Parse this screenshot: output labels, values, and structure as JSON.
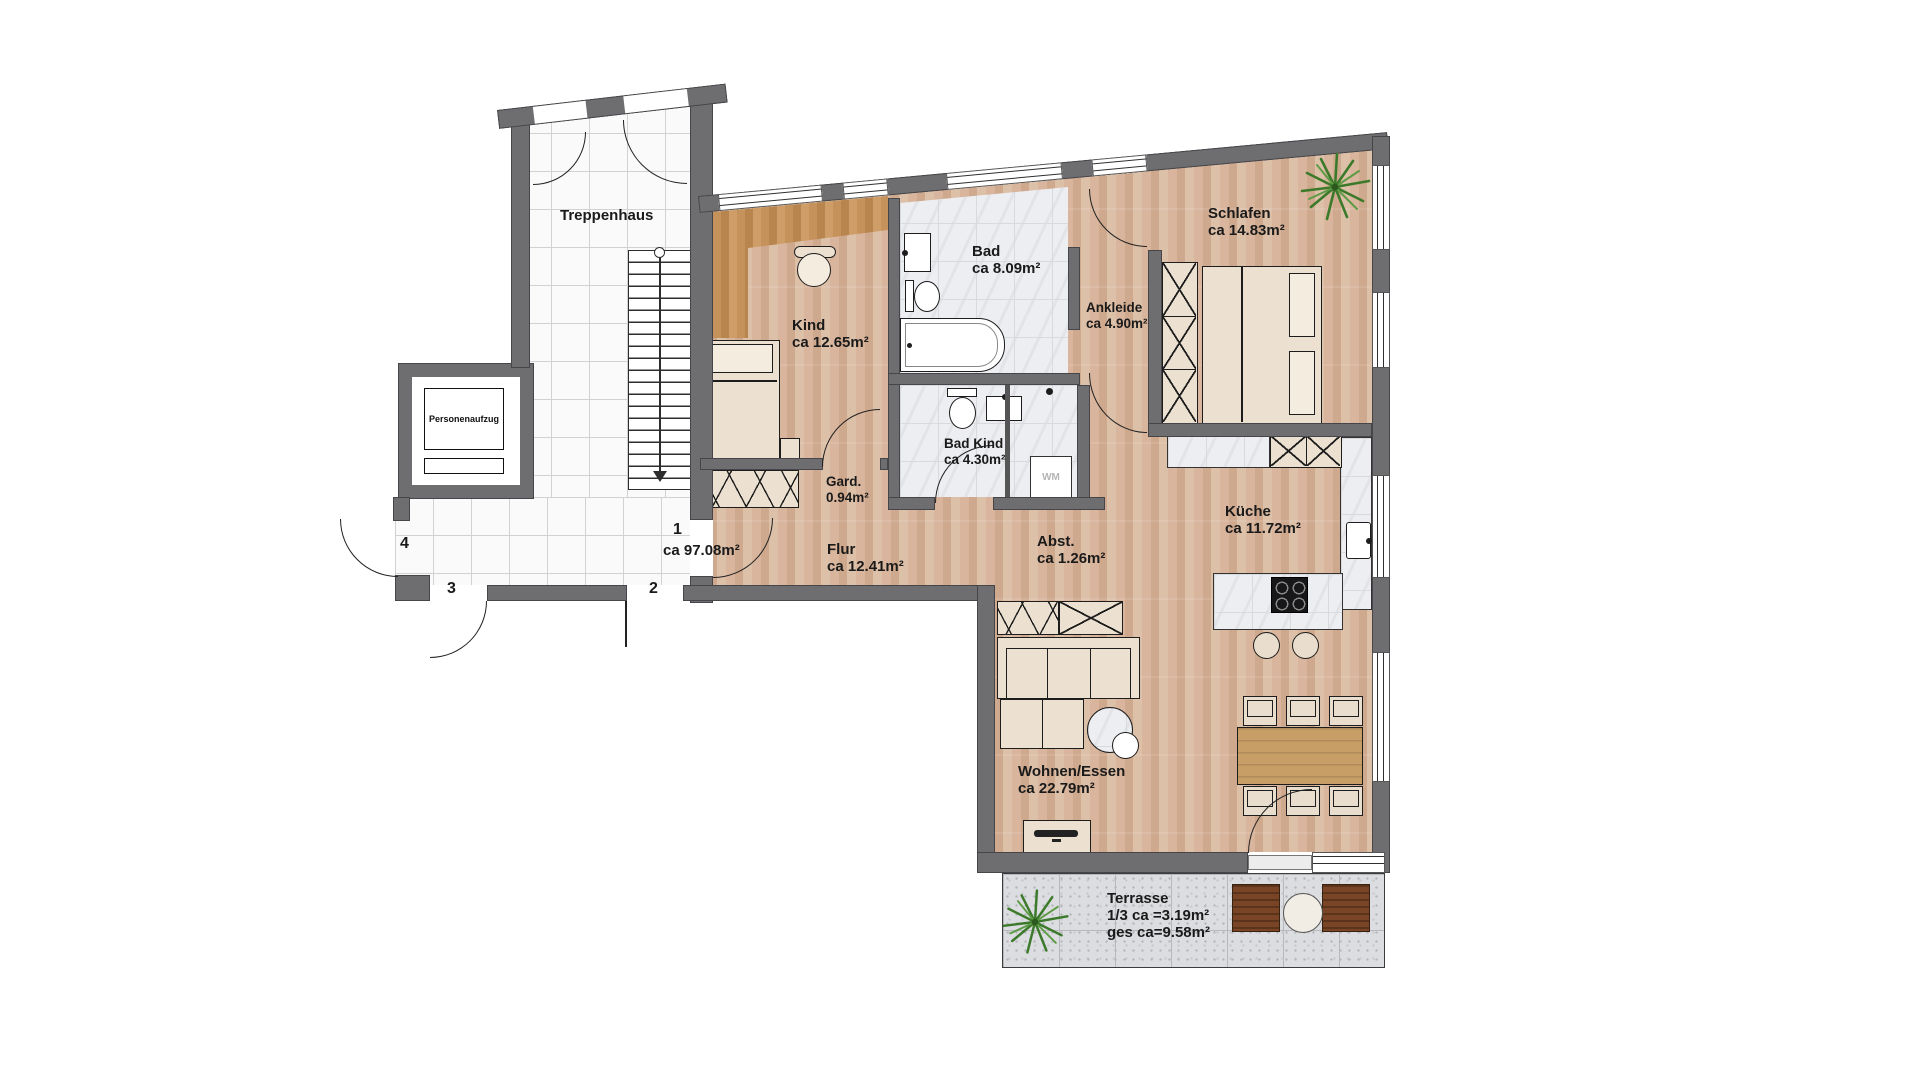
{
  "labels": {
    "treppenhaus": "Treppenhaus",
    "personenaufzug": "Personenaufzug",
    "wm": "WM"
  },
  "rooms": {
    "kind": {
      "name": "Kind",
      "area": "ca 12.65m²"
    },
    "bad": {
      "name": "Bad",
      "area": "ca 8.09m²"
    },
    "schlafen": {
      "name": "Schlafen",
      "area": "ca 14.83m²"
    },
    "ankleide": {
      "name": "Ankleide",
      "area": "ca 4.90m²"
    },
    "bad_kind": {
      "name": "Bad Kind",
      "area": "ca 4.30m²"
    },
    "gard": {
      "name": "Gard.",
      "area": "0.94m²"
    },
    "flur": {
      "name": "Flur",
      "area": "ca 12.41m²"
    },
    "abst": {
      "name": "Abst.",
      "area": "ca 1.26m²"
    },
    "kueche": {
      "name": "Küche",
      "area": "ca 11.72m²"
    },
    "wohnen_essen": {
      "name": "Wohnen/Essen",
      "area": "ca 22.79m²"
    },
    "terrasse": {
      "name": "Terrasse",
      "area_partial": "1/3 ca =3.19m²",
      "area_total": "ges ca=9.58m²"
    }
  },
  "unit": {
    "number": "1",
    "area": "ca 97.08m²"
  },
  "hall_doors": {
    "door2": "2",
    "door3": "3",
    "door4": "4"
  },
  "colors": {
    "wall": "#6e6e70",
    "wood": "#d6b299",
    "accent_wood": "#c6925c",
    "tile": "#fafafa",
    "marble": "#edeef1",
    "terrace": "#dcdde0",
    "plant": "#3c7a2b"
  }
}
